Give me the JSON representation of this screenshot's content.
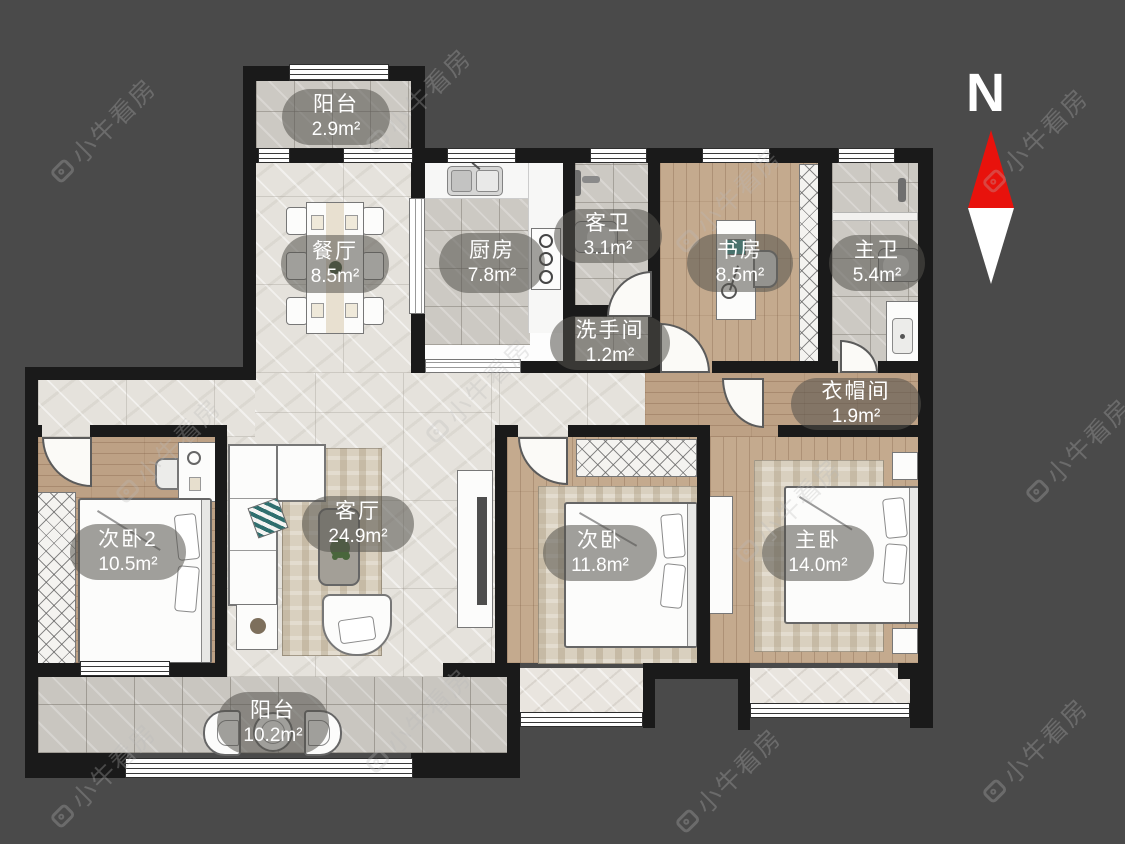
{
  "compass": {
    "label": "N"
  },
  "watermark": {
    "text": "小牛看房"
  },
  "rooms": [
    {
      "id": "balcony-top",
      "name": "阳台",
      "area": "2.9m²"
    },
    {
      "id": "dining",
      "name": "餐厅",
      "area": "8.5m²"
    },
    {
      "id": "kitchen",
      "name": "厨房",
      "area": "7.8m²"
    },
    {
      "id": "guest-bath",
      "name": "客卫",
      "area": "3.1m²"
    },
    {
      "id": "washroom",
      "name": "洗手间",
      "area": "1.2m²"
    },
    {
      "id": "study",
      "name": "书房",
      "area": "8.5m²"
    },
    {
      "id": "master-bath",
      "name": "主卫",
      "area": "5.4m²"
    },
    {
      "id": "cloakroom",
      "name": "衣帽间",
      "area": "1.9m²"
    },
    {
      "id": "bedroom2",
      "name": "次卧2",
      "area": "10.5m²"
    },
    {
      "id": "living",
      "name": "客厅",
      "area": "24.9m²"
    },
    {
      "id": "bedroom",
      "name": "次卧",
      "area": "11.8m²"
    },
    {
      "id": "master-bedroom",
      "name": "主卧",
      "area": "14.0m²"
    },
    {
      "id": "balcony-bottom",
      "name": "阳台",
      "area": "10.2m²"
    }
  ],
  "colors": {
    "background": "#4a4a4a",
    "wall": "#1a1a1a",
    "north_arrow_red": "#e8120c",
    "label_text": "#ffffff"
  }
}
